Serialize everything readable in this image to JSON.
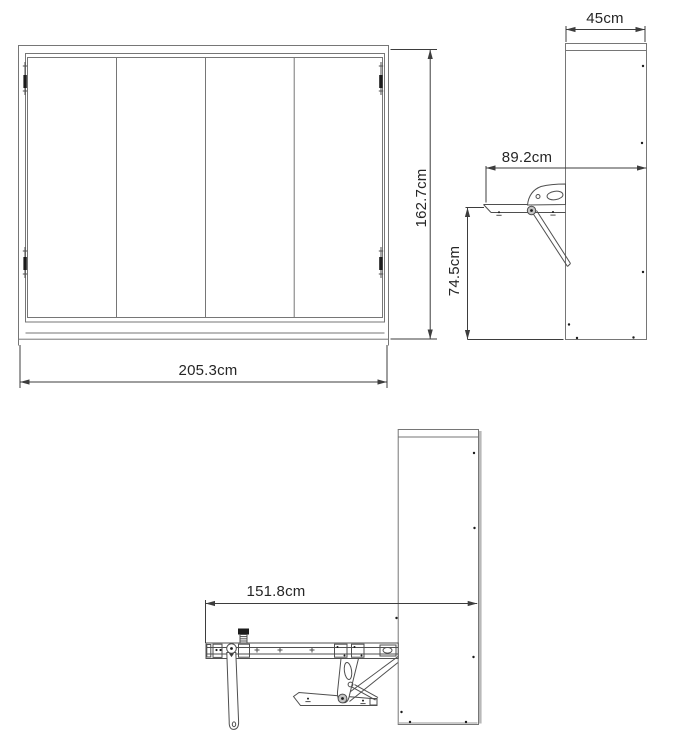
{
  "colors": {
    "background": "#ffffff",
    "furniture_line": "#767676",
    "detail_line": "#4f4f4f",
    "dimension_line": "#3d3d3d",
    "hardware_fill": "#1c1c1c",
    "pivot_fill": "#c4c4c4",
    "panel_edge": "#b9b9b9",
    "text": "#262626"
  },
  "views": {
    "front": {
      "width_dim": "205.3cm",
      "height_dim": "162.7cm"
    },
    "side_folded": {
      "depth_dim": "45cm",
      "tabletop_depth_dim": "89.2cm",
      "tabletop_height_dim": "74.5cm"
    },
    "side_open": {
      "projection_dim": "151.8cm"
    }
  }
}
